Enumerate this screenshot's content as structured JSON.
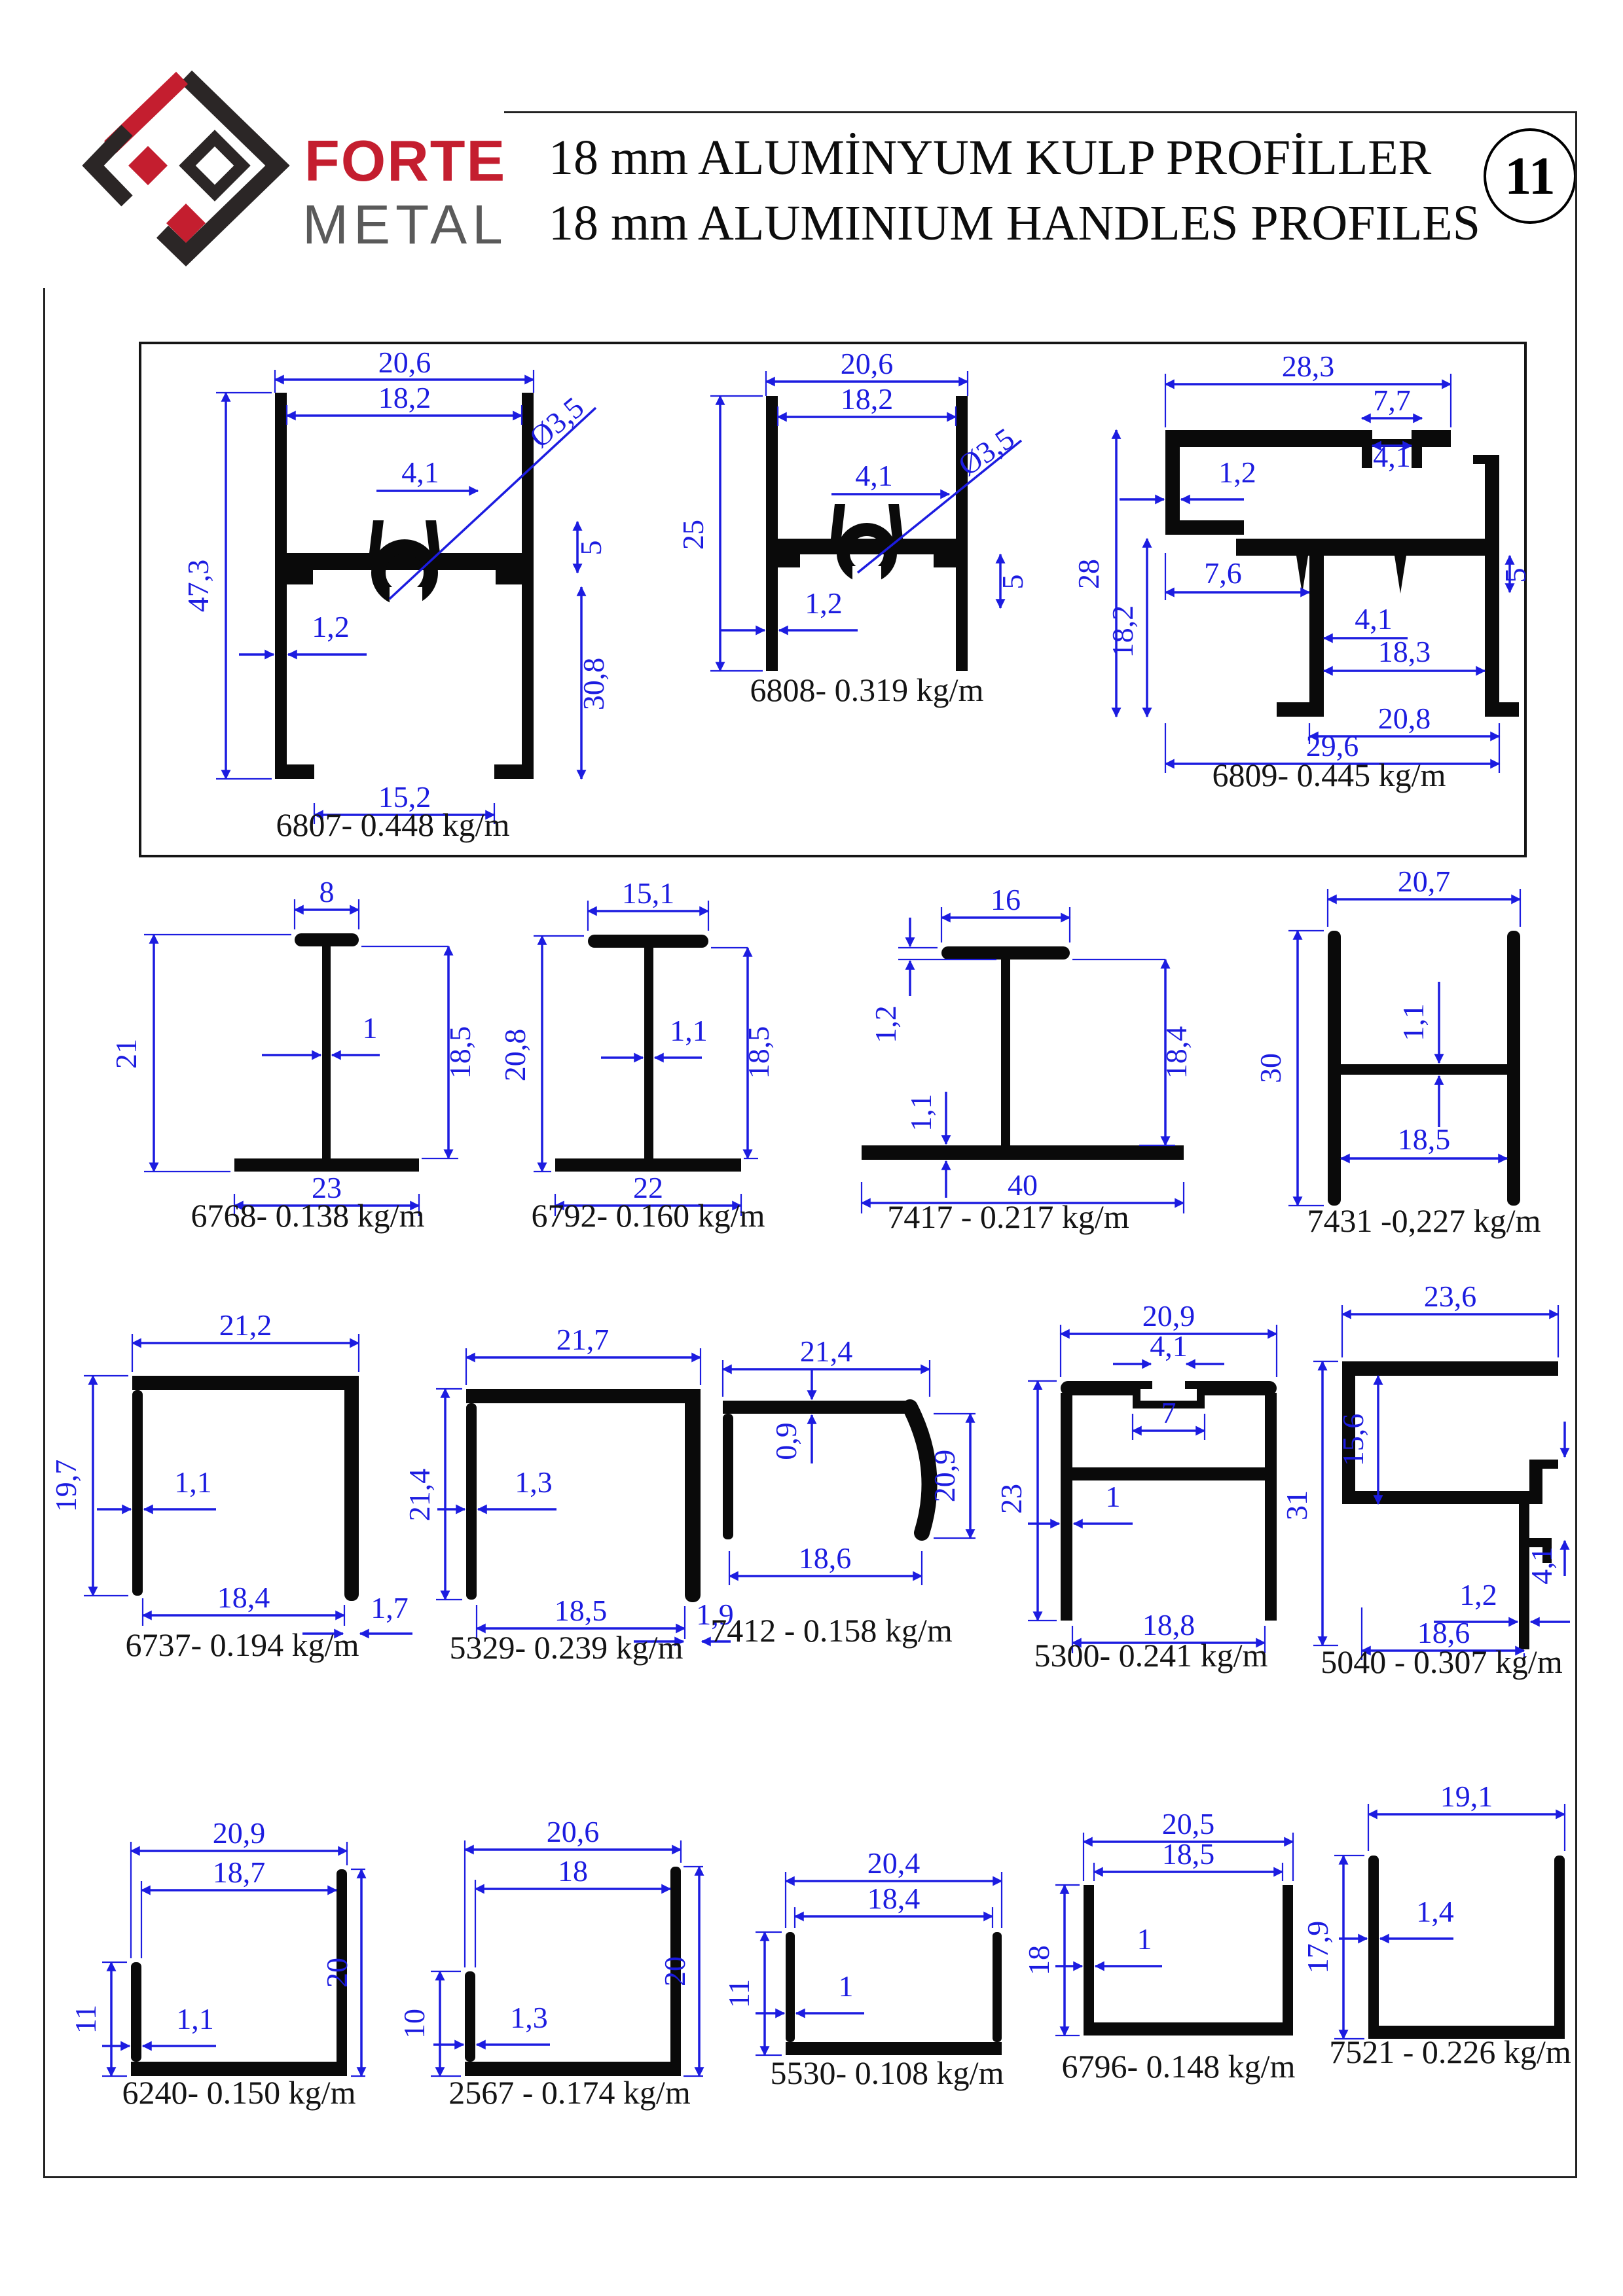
{
  "header": {
    "brand1": "FORTE",
    "brand2": "METAL",
    "title_line1": "18 mm ALUMİNYUM KULP PROFİLLER",
    "title_line2": "18 mm ALUMINIUM HANDLES PROFILES",
    "page_number": "11"
  },
  "colors": {
    "dimension_blue": "#1c1ce0",
    "shape_black": "#0a0a0a",
    "brand_red": "#c41e2f",
    "brand_gray": "#5a5a5a"
  },
  "profiles": {
    "p6807": {
      "label": "6807- 0.448 kg/m",
      "dims": {
        "w1": "20,6",
        "w2": "18,2",
        "hole": "Ø3,5",
        "a": "4,1",
        "b": "5",
        "h": "47,3",
        "t": "1,2",
        "h2": "30,8",
        "wb": "15,2"
      }
    },
    "p6808": {
      "label": "6808- 0.319 kg/m",
      "dims": {
        "w1": "20,6",
        "w2": "18,2",
        "a": "4,1",
        "hole": "Ø3,5",
        "h": "25",
        "b": "5",
        "t": "1,2"
      }
    },
    "p6809": {
      "label": "6809- 0.445 kg/m",
      "dims": {
        "w1": "28,3",
        "w2": "7,7",
        "w3": "4,1",
        "t": "1,2",
        "w4": "7,6",
        "h": "28",
        "h2": "18,2",
        "b": "5",
        "a": "4,1",
        "w5": "18,3",
        "wb1": "20,8",
        "wb2": "29,6"
      }
    },
    "p6768": {
      "label": "6768- 0.138 kg/m",
      "dims": {
        "w1": "8",
        "h": "21",
        "t": "1",
        "h2": "18,5",
        "wb": "23"
      }
    },
    "p6792": {
      "label": "6792- 0.160 kg/m",
      "dims": {
        "w1": "15,1",
        "h": "20,8",
        "t": "1,1",
        "h2": "18,5",
        "wb": "22"
      }
    },
    "p7417": {
      "label": "7417 - 0.217 kg/m",
      "dims": {
        "w1": "16",
        "t1": "1,2",
        "t2": "1,1",
        "h2": "18,4",
        "wb": "40"
      }
    },
    "p7431": {
      "label": "7431 -0,227 kg/m",
      "dims": {
        "w1": "20,7",
        "h": "30",
        "t": "1,1",
        "w2": "18,5"
      }
    },
    "p6737": {
      "label": "6737- 0.194 kg/m",
      "dims": {
        "w1": "21,2",
        "h": "19,7",
        "t": "1,1",
        "wb": "18,4",
        "t2": "1,7"
      }
    },
    "p5329": {
      "label": "5329- 0.239 kg/m",
      "dims": {
        "w1": "21,7",
        "h": "21,4",
        "t": "1,3",
        "wb": "18,5",
        "t2": "1,9"
      }
    },
    "p7412": {
      "label": "7412 - 0.158 kg/m",
      "dims": {
        "w1": "21,4",
        "t": "0,9",
        "h": "20,9",
        "wb": "18,6"
      }
    },
    "p5300": {
      "label": "5300- 0.241 kg/m",
      "dims": {
        "w1": "20,9",
        "a": "4,1",
        "b": "7",
        "h": "23",
        "t": "1",
        "wb": "18,8"
      }
    },
    "p5040": {
      "label": "5040 - 0.307 kg/m",
      "dims": {
        "w1": "23,6",
        "h1": "15,6",
        "h": "31",
        "a": "4,1",
        "t": "1,2",
        "wb": "18,6"
      }
    },
    "p6240": {
      "label": "6240- 0.150 kg/m",
      "dims": {
        "w1": "20,9",
        "w2": "18,7",
        "h1": "11",
        "t": "1,1",
        "h2": "20"
      }
    },
    "p2567": {
      "label": "2567 - 0.174 kg/m",
      "dims": {
        "w1": "20,6",
        "w2": "18",
        "h1": "10",
        "t": "1,3",
        "h2": "20"
      }
    },
    "p5530": {
      "label": "5530- 0.108 kg/m",
      "dims": {
        "w1": "20,4",
        "w2": "18,4",
        "h1": "11",
        "t": "1"
      }
    },
    "p6796": {
      "label": "6796- 0.148 kg/m",
      "dims": {
        "w1": "20,5",
        "w2": "18,5",
        "h1": "18",
        "t": "1"
      }
    },
    "p7521": {
      "label": "7521 - 0.226 kg/m",
      "dims": {
        "w1": "19,1",
        "h1": "17,9",
        "t": "1,4"
      }
    }
  }
}
